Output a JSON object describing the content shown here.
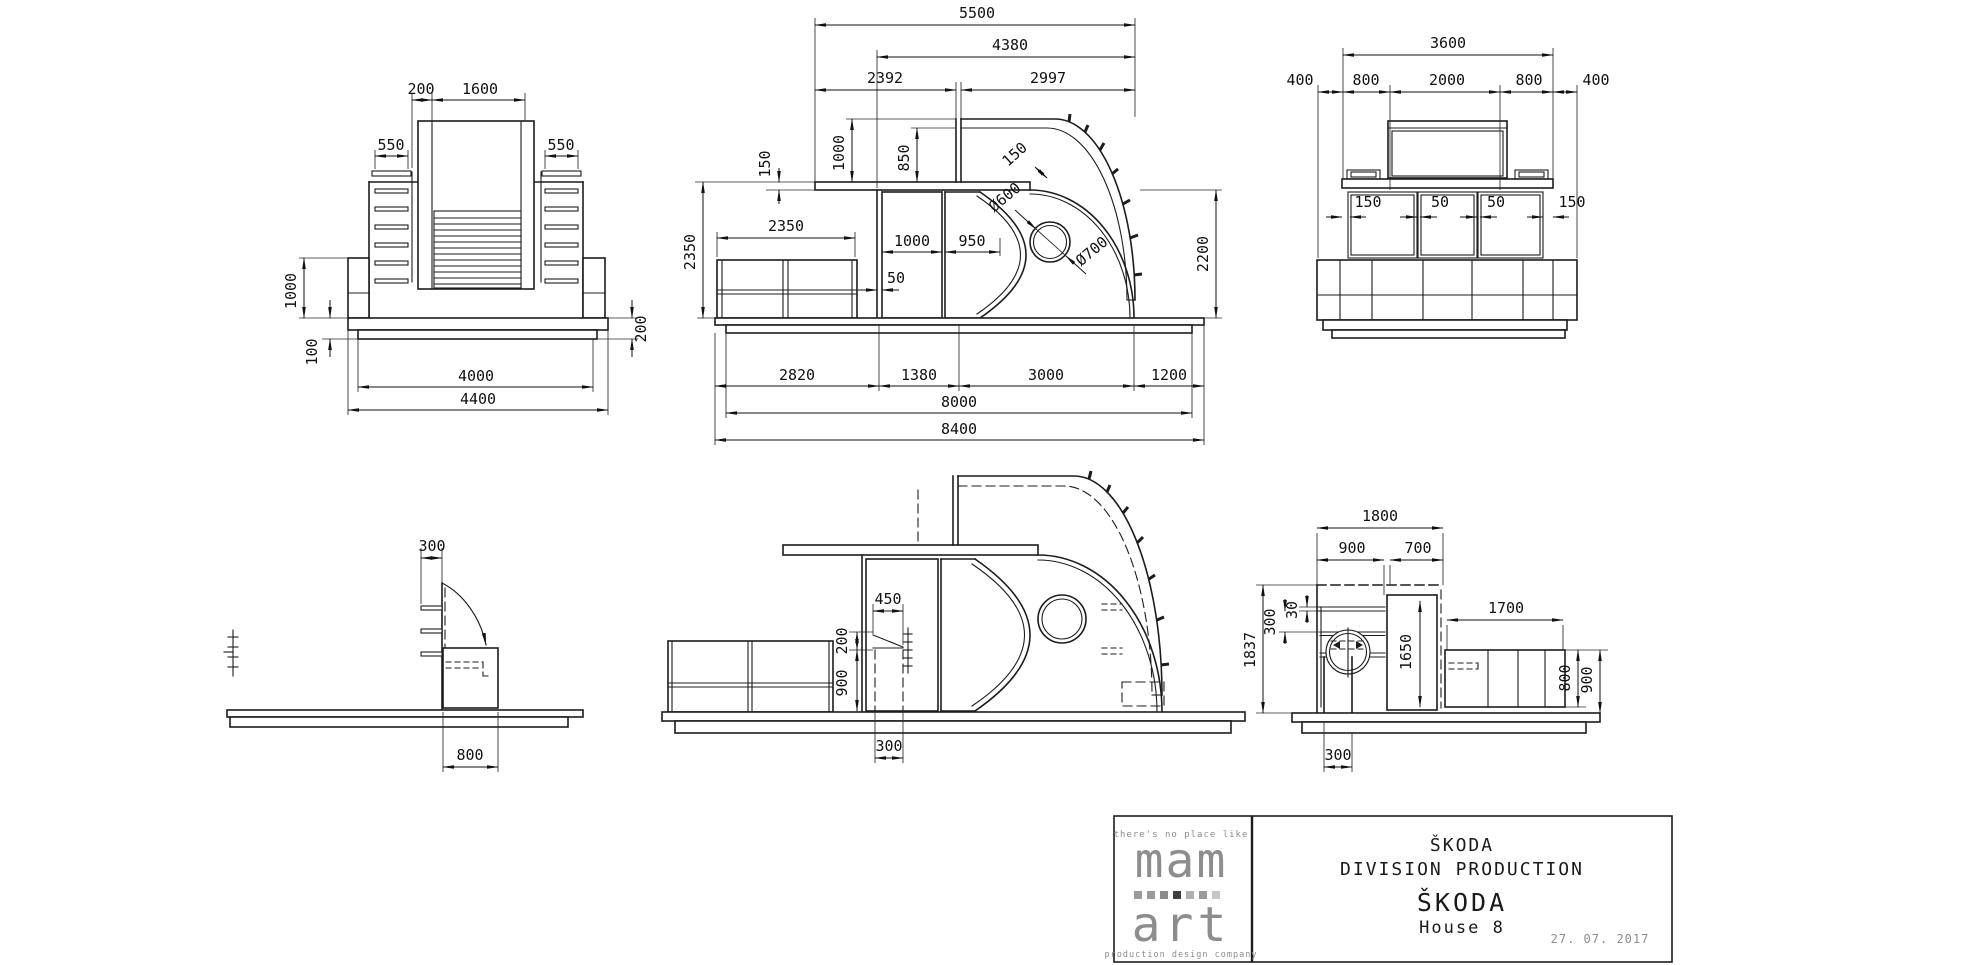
{
  "views": {
    "front": {
      "d200": "200",
      "d1600": "1600",
      "d550l": "550",
      "d550r": "550",
      "d1000": "1000",
      "d100": "100",
      "d200r": "200",
      "d4000": "4000",
      "d4400": "4400"
    },
    "side": {
      "d5500": "5500",
      "d4380": "4380",
      "d2392": "2392",
      "d2997": "2997",
      "d150slab": "150",
      "d1000": "1000",
      "d850": "850",
      "d150band": "150",
      "dia600": "Ø600",
      "dia700": "Ø700",
      "d2350v": "2350",
      "d2350b": "2350",
      "d1000door": "1000",
      "d950": "950",
      "d50": "50",
      "d2200": "2200",
      "d2820": "2820",
      "d1380": "1380",
      "d3000": "3000",
      "d1200": "1200",
      "d8000": "8000",
      "d8400": "8400"
    },
    "rear": {
      "d3600": "3600",
      "d400l": "400",
      "d800l": "800",
      "d2000": "2000",
      "d800r": "800",
      "d400r": "400",
      "d150l": "150",
      "d50a": "50",
      "d50b": "50",
      "d150r": "150"
    },
    "left_side": {
      "d300": "300",
      "d800": "800"
    },
    "section": {
      "d450": "450",
      "d200": "200",
      "d900": "900",
      "d300": "300"
    },
    "right_side": {
      "d1800": "1800",
      "d900": "900",
      "d700": "700",
      "d30": "30",
      "d300": "300",
      "d1650": "1650",
      "d1700": "1700",
      "d800": "800",
      "d900b": "900",
      "d300b": "300",
      "d1837": "1837"
    }
  },
  "title_block": {
    "tagline": "there's no place like",
    "logo_top": "mam",
    "logo_bottom": "art",
    "logo_sub": "production design company",
    "logo_squares": [
      "#9b9b9b",
      "#9b9b9b",
      "#8c8c8c",
      "#3d3d3d",
      "#b0b0b0",
      "#9b9b9b",
      "#c6c6c6"
    ],
    "company": "ŠKODA",
    "department": "DIVISION PRODUCTION",
    "project": "ŠKODA",
    "item": "House 8",
    "date": "27. 07. 2017",
    "line_color": "#1c1c1c"
  }
}
